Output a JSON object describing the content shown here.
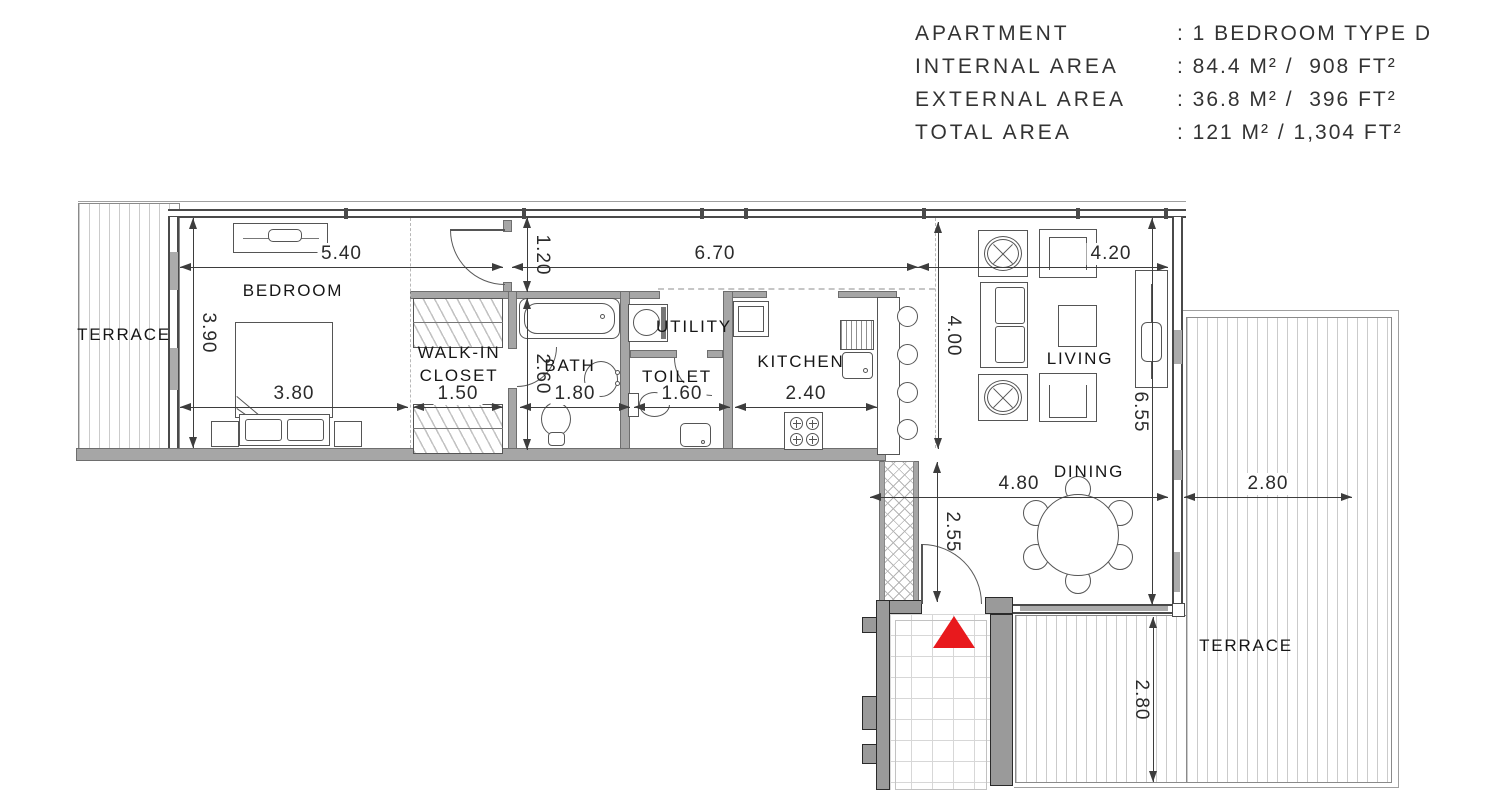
{
  "legend": {
    "rows": [
      {
        "label": "APARTMENT",
        "value": ": 1 BEDROOM TYPE D"
      },
      {
        "label": "INTERNAL AREA",
        "value": ": 84.4 M² /  908 FT²"
      },
      {
        "label": "EXTERNAL AREA",
        "value": ": 36.8 M² /  396 FT²"
      },
      {
        "label": "TOTAL AREA",
        "value": ": 121 M² / 1,304 FT²"
      }
    ]
  },
  "rooms": {
    "terrace_left": "TERRACE",
    "bedroom": "BEDROOM",
    "closet_line1": "WALK-IN",
    "closet_line2": "CLOSET",
    "bath": "BATH",
    "toilet": "TOILET",
    "utility": "UTILITY",
    "kitchen": "KITCHEN",
    "living": "LIVING",
    "dining": "DINING",
    "terrace_right": "TERRACE"
  },
  "dims": {
    "bedroom_w": "5.40",
    "hall_len": "6.70",
    "living_w": "4.20",
    "bedroom_h": "3.90",
    "bed_w": "3.80",
    "closet_w": "1.50",
    "hall_w": "1.20",
    "bath_h": "2.60",
    "bath_w": "1.80",
    "toilet_w": "1.60",
    "kitchen_w": "2.40",
    "living_d": "4.00",
    "living_h": "6.55",
    "dining_w": "4.80",
    "dining_h": "2.55",
    "terrace_w": "2.80",
    "terrace_h": "2.80"
  },
  "colors": {
    "entrance_marker": "#e8191d",
    "wall": "#a6a6a6",
    "wall_dark": "#9a9a9a",
    "hatch": "#cbcbcb"
  }
}
